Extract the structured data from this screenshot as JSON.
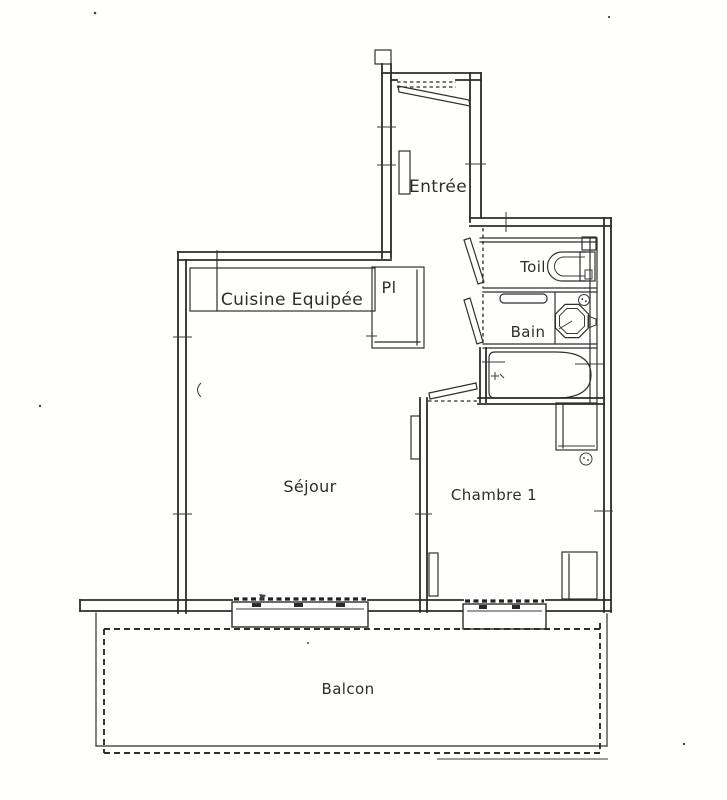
{
  "palette": {
    "paper": "#ffffff",
    "ink": "#2b2b2b"
  },
  "floorplan": {
    "rooms": {
      "entree": {
        "label": "Entrée"
      },
      "cuisine": {
        "label": "Cuisine Equipée"
      },
      "placard": {
        "label": "Pl"
      },
      "toilet": {
        "label": "Toil"
      },
      "bain": {
        "label": "Bain"
      },
      "sejour": {
        "label": "Séjour"
      },
      "chambre": {
        "label": "Chambre 1"
      },
      "balcon": {
        "label": "Balcon"
      }
    }
  }
}
